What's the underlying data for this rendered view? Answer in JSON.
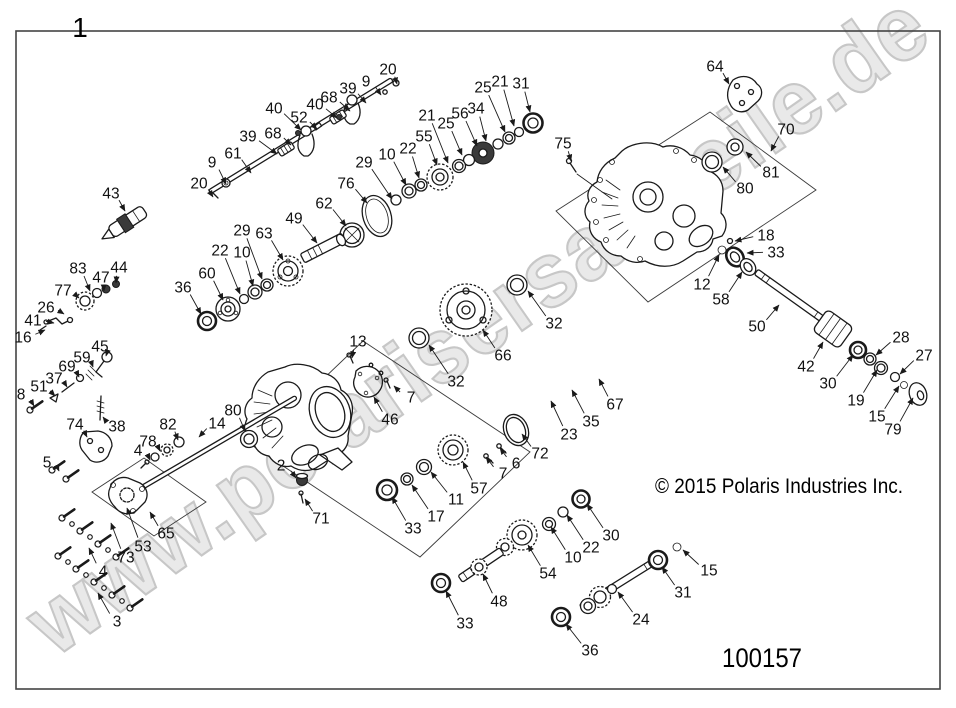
{
  "diagram": {
    "assembly_number": "1",
    "part_number": "100157",
    "copyright": "© 2015 Polaris Industries Inc.",
    "watermark": "www.polarisersatzteile.de"
  },
  "callouts": [
    {
      "n": "20",
      "x": 388,
      "y": 69,
      "tx": 397,
      "ty": 84
    },
    {
      "n": "9",
      "x": 366,
      "y": 81,
      "tx": 381,
      "ty": 95
    },
    {
      "n": "39",
      "x": 348,
      "y": 88,
      "tx": 366,
      "ty": 103
    },
    {
      "n": "68",
      "x": 329,
      "y": 97,
      "tx": 350,
      "ty": 111
    },
    {
      "n": "40",
      "x": 315,
      "y": 104,
      "tx": 337,
      "ty": 118
    },
    {
      "n": "52",
      "x": 299,
      "y": 117,
      "tx": 317,
      "ty": 129
    },
    {
      "n": "40",
      "x": 274,
      "y": 108,
      "tx": 301,
      "ty": 130
    },
    {
      "n": "68",
      "x": 273,
      "y": 133,
      "tx": 291,
      "ty": 145
    },
    {
      "n": "39",
      "x": 248,
      "y": 136,
      "tx": 277,
      "ty": 154
    },
    {
      "n": "61",
      "x": 233,
      "y": 153,
      "tx": 251,
      "ty": 173
    },
    {
      "n": "9",
      "x": 212,
      "y": 162,
      "tx": 226,
      "ty": 184
    },
    {
      "n": "20",
      "x": 199,
      "y": 183,
      "tx": 213,
      "ty": 197
    },
    {
      "n": "31",
      "x": 521,
      "y": 83,
      "tx": 530,
      "ty": 112
    },
    {
      "n": "21",
      "x": 500,
      "y": 81,
      "tx": 514,
      "ty": 126
    },
    {
      "n": "25",
      "x": 483,
      "y": 87,
      "tx": 505,
      "ty": 132
    },
    {
      "n": "34",
      "x": 476,
      "y": 108,
      "tx": 486,
      "ty": 141
    },
    {
      "n": "56",
      "x": 460,
      "y": 113,
      "tx": 477,
      "ty": 146
    },
    {
      "n": "25",
      "x": 446,
      "y": 123,
      "tx": 462,
      "ty": 155
    },
    {
      "n": "21",
      "x": 427,
      "y": 115,
      "tx": 448,
      "ty": 163
    },
    {
      "n": "55",
      "x": 424,
      "y": 136,
      "tx": 437,
      "ty": 165
    },
    {
      "n": "22",
      "x": 408,
      "y": 148,
      "tx": 419,
      "ty": 178
    },
    {
      "n": "10",
      "x": 387,
      "y": 154,
      "tx": 406,
      "ty": 185
    },
    {
      "n": "29",
      "x": 364,
      "y": 162,
      "tx": 392,
      "ty": 199
    },
    {
      "n": "76",
      "x": 346,
      "y": 183,
      "tx": 367,
      "ty": 203
    },
    {
      "n": "62",
      "x": 324,
      "y": 203,
      "tx": 346,
      "ty": 226
    },
    {
      "n": "49",
      "x": 294,
      "y": 218,
      "tx": 317,
      "ty": 243
    },
    {
      "n": "63",
      "x": 264,
      "y": 233,
      "tx": 283,
      "ty": 260
    },
    {
      "n": "29",
      "x": 242,
      "y": 230,
      "tx": 262,
      "ty": 279
    },
    {
      "n": "10",
      "x": 242,
      "y": 252,
      "tx": 253,
      "ty": 286
    },
    {
      "n": "22",
      "x": 220,
      "y": 250,
      "tx": 240,
      "ty": 294
    },
    {
      "n": "60",
      "x": 207,
      "y": 273,
      "tx": 223,
      "ty": 300
    },
    {
      "n": "36",
      "x": 183,
      "y": 287,
      "tx": 201,
      "ty": 314
    },
    {
      "n": "43",
      "x": 111,
      "y": 193,
      "tx": 125,
      "ty": 211
    },
    {
      "n": "83",
      "x": 78,
      "y": 268,
      "tx": 90,
      "ty": 291
    },
    {
      "n": "47",
      "x": 101,
      "y": 277,
      "tx": 104,
      "ty": 291
    },
    {
      "n": "44",
      "x": 119,
      "y": 267,
      "tx": 116,
      "ty": 283
    },
    {
      "n": "77",
      "x": 63,
      "y": 290,
      "tx": 79,
      "ty": 298
    },
    {
      "n": "26",
      "x": 46,
      "y": 307,
      "tx": 64,
      "ty": 314
    },
    {
      "n": "41",
      "x": 33,
      "y": 320,
      "tx": 54,
      "ty": 323
    },
    {
      "n": "16",
      "x": 23,
      "y": 337,
      "tx": 45,
      "ty": 330
    },
    {
      "n": "45",
      "x": 100,
      "y": 346,
      "tx": 106,
      "ty": 356
    },
    {
      "n": "59",
      "x": 82,
      "y": 357,
      "tx": 93,
      "ty": 367
    },
    {
      "n": "69",
      "x": 67,
      "y": 366,
      "tx": 79,
      "ty": 377
    },
    {
      "n": "37",
      "x": 54,
      "y": 378,
      "tx": 67,
      "ty": 387
    },
    {
      "n": "51",
      "x": 39,
      "y": 386,
      "tx": 55,
      "ty": 396
    },
    {
      "n": "8",
      "x": 21,
      "y": 394,
      "tx": 34,
      "ty": 406
    },
    {
      "n": "74",
      "x": 75,
      "y": 424,
      "tx": 87,
      "ty": 437
    },
    {
      "n": "38",
      "x": 117,
      "y": 426,
      "tx": 103,
      "ty": 417
    },
    {
      "n": "5",
      "x": 47,
      "y": 462,
      "tx": 59,
      "ty": 471
    },
    {
      "n": "82",
      "x": 168,
      "y": 424,
      "tx": 178,
      "ty": 440
    },
    {
      "n": "78",
      "x": 148,
      "y": 441,
      "tx": 160,
      "ty": 451
    },
    {
      "n": "4",
      "x": 138,
      "y": 450,
      "tx": 150,
      "ty": 460
    },
    {
      "n": "14",
      "x": 217,
      "y": 423,
      "tx": 199,
      "ty": 437
    },
    {
      "n": "80",
      "x": 233,
      "y": 410,
      "tx": 245,
      "ty": 431
    },
    {
      "n": "65",
      "x": 166,
      "y": 533,
      "tx": 150,
      "ty": 512
    },
    {
      "n": "53",
      "x": 143,
      "y": 546,
      "tx": 127,
      "ty": 508
    },
    {
      "n": "73",
      "x": 126,
      "y": 557,
      "tx": 111,
      "ty": 523
    },
    {
      "n": "4",
      "x": 103,
      "y": 571,
      "tx": 89,
      "ty": 548
    },
    {
      "n": "3",
      "x": 117,
      "y": 621,
      "tx": 98,
      "ty": 593
    },
    {
      "n": "2",
      "x": 281,
      "y": 465,
      "tx": 296,
      "ty": 478
    },
    {
      "n": "71",
      "x": 321,
      "y": 518,
      "tx": 305,
      "ty": 499
    },
    {
      "n": "13",
      "x": 358,
      "y": 341,
      "tx": 352,
      "ty": 358
    },
    {
      "n": "32",
      "x": 554,
      "y": 323,
      "tx": 528,
      "ty": 291
    },
    {
      "n": "66",
      "x": 503,
      "y": 355,
      "tx": 483,
      "ty": 330
    },
    {
      "n": "32",
      "x": 456,
      "y": 381,
      "tx": 429,
      "ty": 345
    },
    {
      "n": "7",
      "x": 411,
      "y": 397,
      "tx": 394,
      "ty": 386
    },
    {
      "n": "46",
      "x": 390,
      "y": 419,
      "tx": 374,
      "ty": 397
    },
    {
      "n": "72",
      "x": 540,
      "y": 453,
      "tx": 522,
      "ty": 434
    },
    {
      "n": "6",
      "x": 516,
      "y": 463,
      "tx": 500,
      "ty": 448
    },
    {
      "n": "7",
      "x": 503,
      "y": 473,
      "tx": 486,
      "ty": 457
    },
    {
      "n": "57",
      "x": 479,
      "y": 488,
      "tx": 463,
      "ty": 462
    },
    {
      "n": "11",
      "x": 456,
      "y": 499,
      "tx": 431,
      "ty": 472
    },
    {
      "n": "17",
      "x": 436,
      "y": 516,
      "tx": 412,
      "ty": 485
    },
    {
      "n": "33",
      "x": 413,
      "y": 528,
      "tx": 392,
      "ty": 497
    },
    {
      "n": "23",
      "x": 569,
      "y": 434,
      "tx": 551,
      "ty": 401
    },
    {
      "n": "35",
      "x": 591,
      "y": 421,
      "tx": 572,
      "ty": 390
    },
    {
      "n": "67",
      "x": 615,
      "y": 404,
      "tx": 599,
      "ty": 379
    },
    {
      "n": "30",
      "x": 611,
      "y": 535,
      "tx": 587,
      "ty": 504
    },
    {
      "n": "22",
      "x": 591,
      "y": 547,
      "tx": 567,
      "ty": 515
    },
    {
      "n": "10",
      "x": 573,
      "y": 557,
      "tx": 551,
      "ty": 527
    },
    {
      "n": "54",
      "x": 548,
      "y": 573,
      "tx": 528,
      "ty": 545
    },
    {
      "n": "48",
      "x": 499,
      "y": 601,
      "tx": 483,
      "ty": 574
    },
    {
      "n": "33",
      "x": 465,
      "y": 623,
      "tx": 446,
      "ty": 591
    },
    {
      "n": "36",
      "x": 590,
      "y": 650,
      "tx": 566,
      "ty": 624
    },
    {
      "n": "24",
      "x": 641,
      "y": 619,
      "tx": 618,
      "ty": 592
    },
    {
      "n": "31",
      "x": 683,
      "y": 592,
      "tx": 662,
      "ty": 567
    },
    {
      "n": "15",
      "x": 709,
      "y": 570,
      "tx": 683,
      "ty": 550
    },
    {
      "n": "64",
      "x": 715,
      "y": 66,
      "tx": 729,
      "ty": 84
    },
    {
      "n": "75",
      "x": 563,
      "y": 143,
      "tx": 571,
      "ty": 161
    },
    {
      "n": "70",
      "x": 786,
      "y": 129,
      "tx": 771,
      "ty": 151
    },
    {
      "n": "81",
      "x": 771,
      "y": 172,
      "tx": 746,
      "ty": 152
    },
    {
      "n": "80",
      "x": 745,
      "y": 188,
      "tx": 723,
      "ty": 167
    },
    {
      "n": "18",
      "x": 766,
      "y": 235,
      "tx": 735,
      "ty": 241
    },
    {
      "n": "33",
      "x": 776,
      "y": 252,
      "tx": 747,
      "ty": 253
    },
    {
      "n": "12",
      "x": 702,
      "y": 284,
      "tx": 719,
      "ty": 255
    },
    {
      "n": "58",
      "x": 721,
      "y": 299,
      "tx": 742,
      "ty": 272
    },
    {
      "n": "50",
      "x": 757,
      "y": 326,
      "tx": 779,
      "ty": 305
    },
    {
      "n": "42",
      "x": 806,
      "y": 366,
      "tx": 823,
      "ty": 342
    },
    {
      "n": "30",
      "x": 828,
      "y": 383,
      "tx": 853,
      "ty": 355
    },
    {
      "n": "19",
      "x": 856,
      "y": 400,
      "tx": 877,
      "ty": 370
    },
    {
      "n": "15",
      "x": 877,
      "y": 416,
      "tx": 899,
      "ty": 386
    },
    {
      "n": "79",
      "x": 893,
      "y": 429,
      "tx": 913,
      "ty": 398
    },
    {
      "n": "28",
      "x": 901,
      "y": 337,
      "tx": 876,
      "ty": 355
    },
    {
      "n": "27",
      "x": 924,
      "y": 355,
      "tx": 900,
      "ty": 374
    }
  ]
}
